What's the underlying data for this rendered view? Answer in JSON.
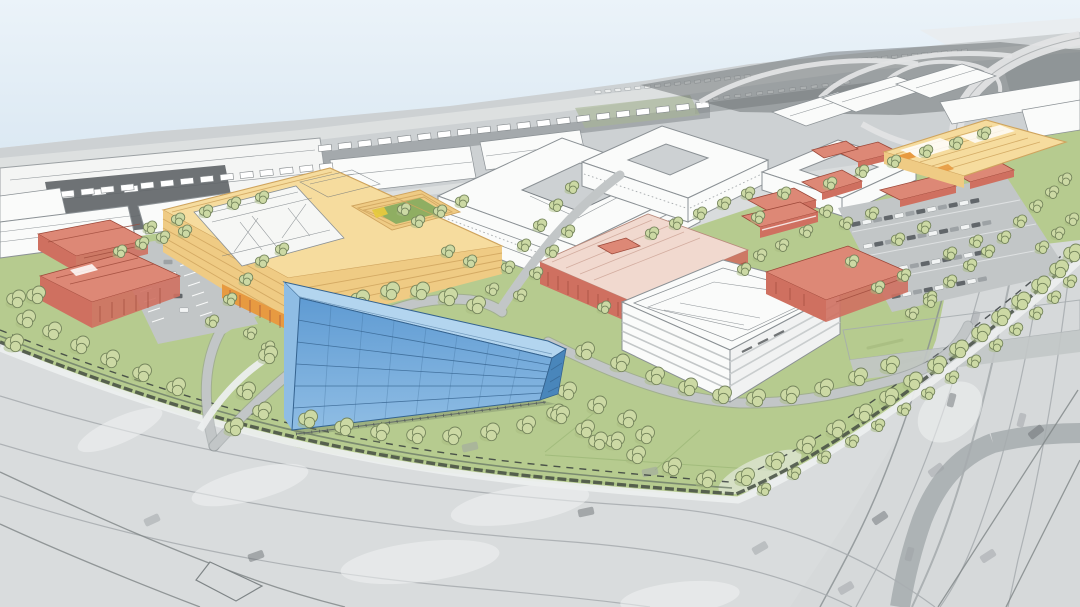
{
  "scene": {
    "title": "Campus master plan — aerial perspective rendering",
    "type": "architectural aerial rendering",
    "description": "Bird's-eye illustrative rendering of a development site. Colored proposed buildings (large yellow courtyard complex with white skylight roof and garden courtyard, blue glass office block in the foreground, white parking structure with rooftop deck, and a family of salmon-red buildings) sit on a landscaped campus with street trees, surface parking lots, lawns and a dark perimeter hedge with a dashed property line. The surrounding context is drawn in grayscale: warehouse rooftops, trailer yards, rows of small buildings, a freeway interchange at the upper right, a wide arterial road across the foreground and a freeway with overpass along the right edge. White line-drawn courtyard blocks and gabled industrial buildings form the mid-ground. No text appears in the image.",
    "view": "aerial three-quarter perspective, horizon sloping down to the right",
    "visible_text": "none"
  },
  "palette": {
    "sky-top": "#ebf3f9",
    "sky-bottom": "#dce9f3",
    "ctx-base": "#cdd1d3",
    "ctx-light": "#e1e3e4",
    "ctx-mid": "#aab0b2",
    "ctx-dark": "#84898c",
    "ctx-darker": "#5f6467",
    "white-bldg": "#fafbfa",
    "line": "#8b9195",
    "sketch": "#6e747a",
    "lawn": "#b6cb8f",
    "lawn-dark": "#9db878",
    "courtyard-green": "#8fae62",
    "tree": "#ccd9a4",
    "tree-dark": "#a8bc80",
    "tree-line": "#75855c",
    "hedge": "#454e43",
    "road-campus": "#c2c6c7",
    "road-fore": "#d9dcdd",
    "road-hwy": "#d6d9da",
    "road-light": "#eceeee",
    "curb": "#878d90",
    "ramp-dark": "#a6abae",
    "yellow-roof": "#f6dc9e",
    "yellow-face": "#efcb84",
    "yellow-line": "#cfa45e",
    "orange": "#e79a41",
    "red-face": "#cf7060",
    "red-roof": "#dd8876",
    "red-light": "#f1d9cf",
    "red-dark": "#9c4839",
    "blue-top": "#b3d5ef",
    "blue-hi": "#8fbde4",
    "blue-face": "#5f9bd3",
    "blue-side": "#4986bb",
    "blue-line": "#35638f",
    "car-light": "#f2f4f4",
    "car-mid": "#9da2a5",
    "car-dark": "#61666a",
    "dash": "#2f3437"
  },
  "elements": [
    {
      "name": "sky",
      "colors": [
        "sky-top",
        "sky-bottom"
      ]
    },
    {
      "name": "background-cityscape",
      "note": "grayscale aerial context: warehouses, trailer rows, small building rows",
      "colors": [
        "ctx-base",
        "ctx-dark"
      ]
    },
    {
      "name": "freeway-interchange",
      "note": "top right, curving light ramps over dark ground",
      "colors": [
        "ctx-darker",
        "ctx-light"
      ]
    },
    {
      "name": "white-outline-buildings",
      "note": "mid-ground courtyard blocks and gabled sheds drawn as white line work",
      "colors": [
        "white-bldg",
        "line"
      ]
    },
    {
      "name": "campus-lawn",
      "colors": [
        "lawn"
      ]
    },
    {
      "name": "yellow-courtyard-building",
      "note": "large two-wing complex, white skylight roof panel, stepped garden courtyard, orange slatted base",
      "colors": [
        "yellow-roof",
        "yellow-face",
        "orange",
        "courtyard-green"
      ]
    },
    {
      "name": "yellow-building-northeast",
      "colors": [
        "yellow-roof",
        "orange"
      ]
    },
    {
      "name": "red-buildings",
      "note": "salmon buildings: two at west edge, large pale-roof hall in center, one east of parking structure, scattered small cluster northeast",
      "colors": [
        "red-roof",
        "red-face",
        "red-light"
      ]
    },
    {
      "name": "parking-structure",
      "note": "white, five striped levels, rooftop parking deck with aisle lines",
      "colors": [
        "white-bldg"
      ]
    },
    {
      "name": "blue-glass-office-building",
      "note": "foreground five-story glass box with floor lines and mullions",
      "colors": [
        "blue-top",
        "blue-face",
        "blue-side"
      ]
    },
    {
      "name": "surface-parking-lots",
      "note": "west lot with white stalls; large east lot full of cars",
      "colors": [
        "road-campus",
        "car-light",
        "car-dark"
      ]
    },
    {
      "name": "street-trees",
      "note": "rows of round sketched trees along roads, boundary and freeway edge",
      "colors": [
        "tree",
        "tree-line"
      ]
    },
    {
      "name": "perimeter-hedge-and-property-line",
      "colors": [
        "hedge",
        "dash"
      ]
    },
    {
      "name": "arterial-road-foreground",
      "note": "wide gray road with faint lanes, ghost cars, white wear patches",
      "colors": [
        "road-fore"
      ]
    },
    {
      "name": "freeway-right",
      "note": "runs down right side with dark overpass bands and curving ramp",
      "colors": [
        "road-hwy",
        "ramp-dark"
      ]
    }
  ]
}
